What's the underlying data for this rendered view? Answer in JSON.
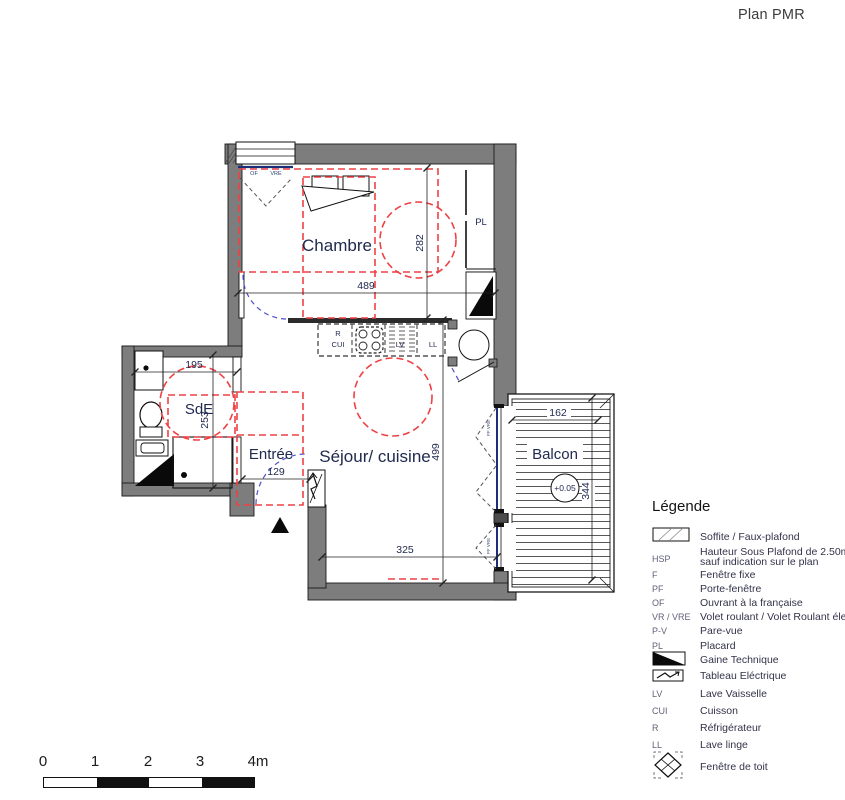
{
  "title": "Plan PMR",
  "plan": {
    "rooms": {
      "chambre": "Chambre",
      "sde": "SdE",
      "entree": "Entrée",
      "sejour": "Séjour/ cuisine",
      "balcon": "Balcon"
    },
    "labels": {
      "pl": "PL",
      "r": "R",
      "cui": "CUI",
      "lv": "LV",
      "ll": "LL",
      "of": "OF",
      "vre": "VRE",
      "pf_vre": "PF VRE",
      "level": "+0.05"
    },
    "dims": {
      "d489": "489",
      "d282": "282",
      "d499": "499",
      "d325": "325",
      "d195": "195",
      "d253": "253",
      "d129": "129",
      "d162": "162",
      "d344": "344"
    }
  },
  "legend": {
    "title": "Légende",
    "items": [
      {
        "key": "",
        "label": "Soffite / Faux-plafond"
      },
      {
        "key": "HSP",
        "label": "Hauteur Sous Plafond de 2.50m",
        "label2": "sauf indication sur le plan"
      },
      {
        "key": "F",
        "label": "Fenêtre fixe"
      },
      {
        "key": "PF",
        "label": "Porte-fenêtre"
      },
      {
        "key": "OF",
        "label": "Ouvrant à la française"
      },
      {
        "key": "VR / VRE",
        "label": "Volet roulant / Volet Roulant électrique"
      },
      {
        "key": "P-V",
        "label": "Pare-vue"
      },
      {
        "key": "PL",
        "label": "Placard"
      },
      {
        "key": "",
        "label": "Gaine Technique"
      },
      {
        "key": "",
        "label": "Tableau Eléctrique"
      },
      {
        "key": "LV",
        "label": "Lave Vaisselle"
      },
      {
        "key": "CUI",
        "label": "Cuisson"
      },
      {
        "key": "R",
        "label": "Réfrigérateur"
      },
      {
        "key": "LL",
        "label": "Lave linge"
      },
      {
        "key": "",
        "label": "Fenêtre de toit"
      }
    ]
  },
  "scalebar": {
    "ticks": [
      "0",
      "1",
      "2",
      "3",
      "4m"
    ]
  },
  "colors": {
    "wall": "#7d7d7d",
    "red": "#ee4145",
    "blue": "#5050cc",
    "glazing": "#1b2f78",
    "text": "#202a4e"
  }
}
